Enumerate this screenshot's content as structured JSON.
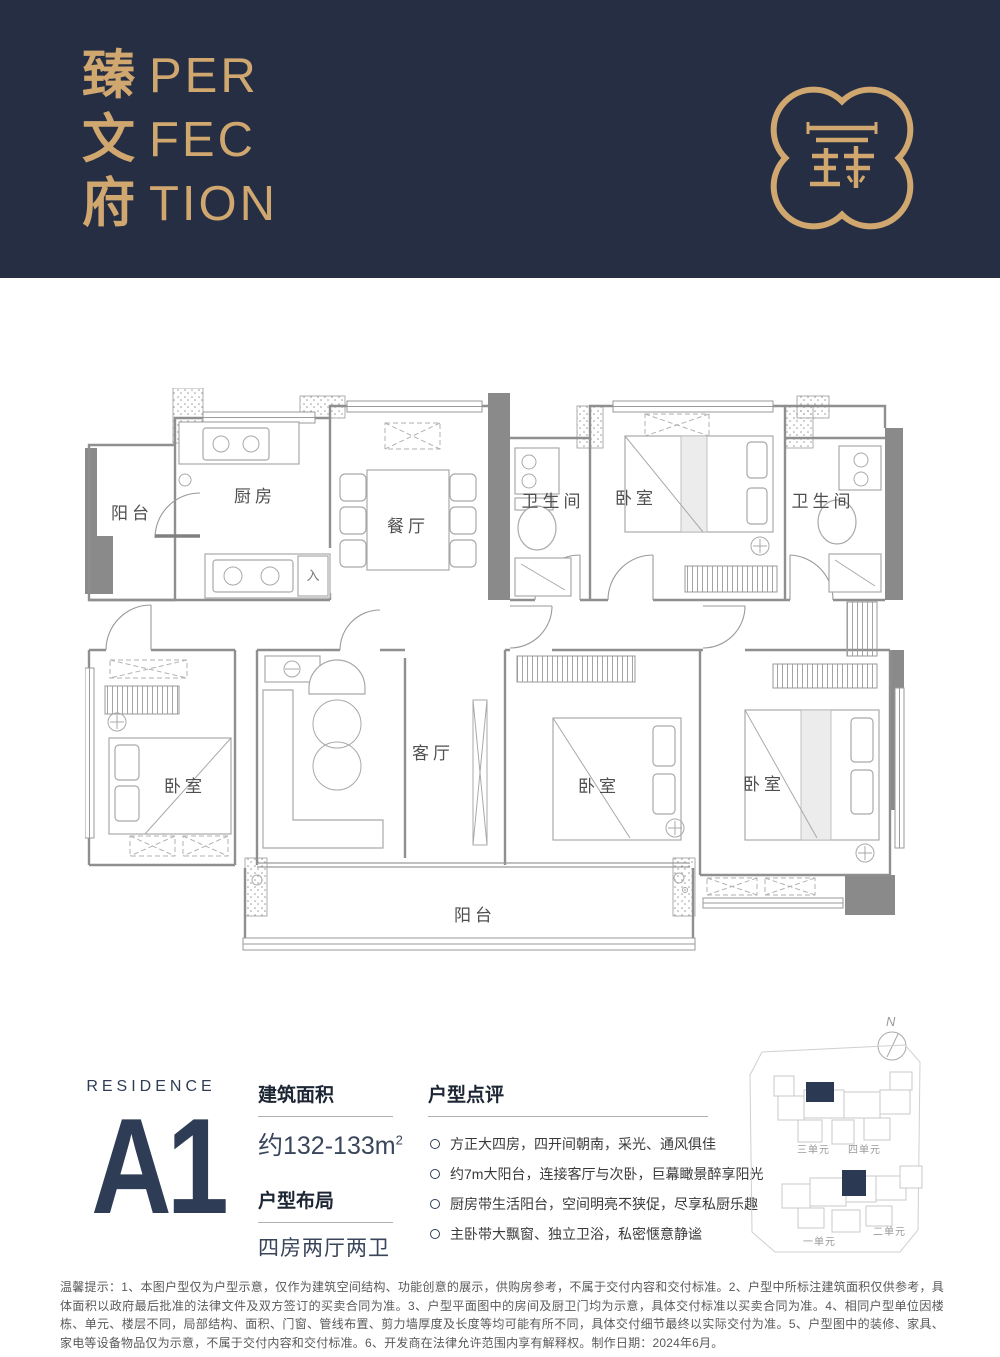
{
  "header": {
    "brand_cn": [
      "臻",
      "文",
      "府"
    ],
    "brand_en_lines": [
      "PER",
      "FEC",
      "TION"
    ],
    "logo": "quatrefoil-seal"
  },
  "floorplan": {
    "entry_mark": "入",
    "rooms": [
      {
        "id": "balcony-top",
        "label": "阳台"
      },
      {
        "id": "kitchen",
        "label": "厨房"
      },
      {
        "id": "dining",
        "label": "餐厅"
      },
      {
        "id": "bath-1",
        "label": "卫生间"
      },
      {
        "id": "bedroom-top",
        "label": "卧室"
      },
      {
        "id": "bath-2",
        "label": "卫生间"
      },
      {
        "id": "bedroom-left",
        "label": "卧室"
      },
      {
        "id": "living",
        "label": "客厅"
      },
      {
        "id": "bedroom-mid",
        "label": "卧室"
      },
      {
        "id": "bedroom-right",
        "label": "卧室"
      },
      {
        "id": "balcony-bottom",
        "label": "阳台"
      }
    ]
  },
  "residence": {
    "eyebrow": "RESIDENCE",
    "code": "A1"
  },
  "specs": [
    {
      "title": "建筑面积",
      "value": "约132-133m",
      "sup": "2"
    },
    {
      "title": "户型布局",
      "value": "四房两厅两卫",
      "sup": ""
    }
  ],
  "review": {
    "title": "户型点评",
    "bullets": [
      "方正大四房，四开间朝南，采光、通风俱佳",
      "约7m大阳台，连接客厅与次卧，巨幕瞰景醉享阳光",
      "厨房带生活阳台，空间明亮不狭促，尽享私厨乐趣",
      "主卧带大飘窗、独立卫浴，私密惬意静谧"
    ]
  },
  "sitemap": {
    "compass": "N",
    "units": [
      {
        "label": "三单元"
      },
      {
        "label": "四单元"
      },
      {
        "label": "一单元"
      },
      {
        "label": "二单元"
      }
    ]
  },
  "disclaimer": "温馨提示：1、本图户型仅为户型示意，仅作为建筑空间结构、功能创意的展示，供购房参考，不属于交付内容和交付标准。2、户型中所标注建筑面积仅供参考，具体面积以政府最后批准的法律文件及双方签订的买卖合同为准。3、户型平面图中的房间及厨卫门均为示意，具体交付标准以买卖合同为准。4、相同户型单位因楼栋、单元、楼层不同，局部结构、面积、门窗、管线布置、剪力墙厚度及长度等均可能有所不同，具体交付细节最终以实际交付为准。5、户型图中的装修、家具、家电等设备物品仅为示意，不属于交付内容和交付标准。6、开发商在法律允许范围内享有解释权。制作日期：2024年6月。",
  "colors": {
    "navy": "#252e43",
    "gold": "#d1a770",
    "accent": "#2e3d55"
  }
}
